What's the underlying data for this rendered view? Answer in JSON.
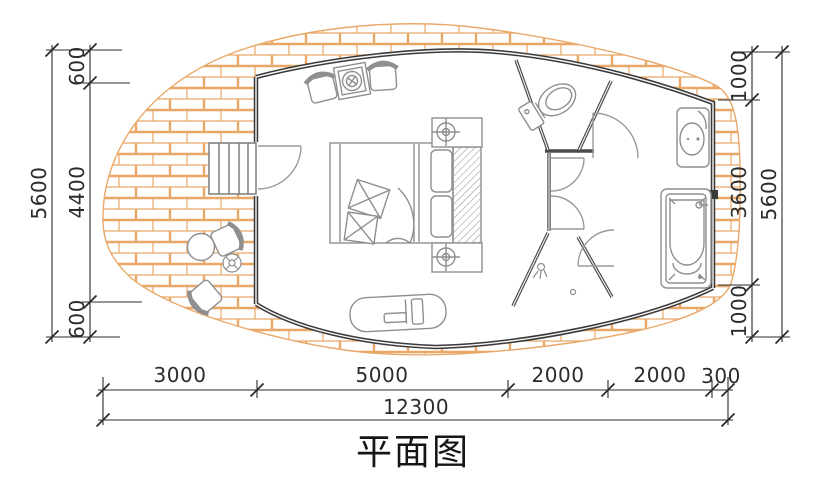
{
  "title": "平面图",
  "dimensions": {
    "left": {
      "segments": [
        "600",
        "4400",
        "600"
      ],
      "total": "5600"
    },
    "right": {
      "segments": [
        "1000",
        "3600",
        "1000"
      ],
      "total": "5600"
    },
    "bottom": {
      "segments": [
        "3000",
        "5000",
        "2000",
        "2000",
        "300"
      ],
      "total": "12300"
    }
  },
  "colors": {
    "background": "#ffffff",
    "brick_line": "#e9a868",
    "exterior_wall": "#3a3a3a",
    "partition_wall": "#4a4a4a",
    "furniture_line": "#8f8f8f",
    "dimension_line": "#2b2b2b"
  },
  "symbols": [
    "brick-paved-deck",
    "staircase",
    "entry-door",
    "interior-door",
    "armchair",
    "stove-table",
    "double-bed",
    "pillow",
    "cushion",
    "nightstand",
    "ceiling-lamp",
    "headboard",
    "daybed-bench",
    "outdoor-chair",
    "outdoor-round-table",
    "plant",
    "toilet",
    "sink-vanity",
    "bathtub",
    "shower-head",
    "floor-drain"
  ]
}
